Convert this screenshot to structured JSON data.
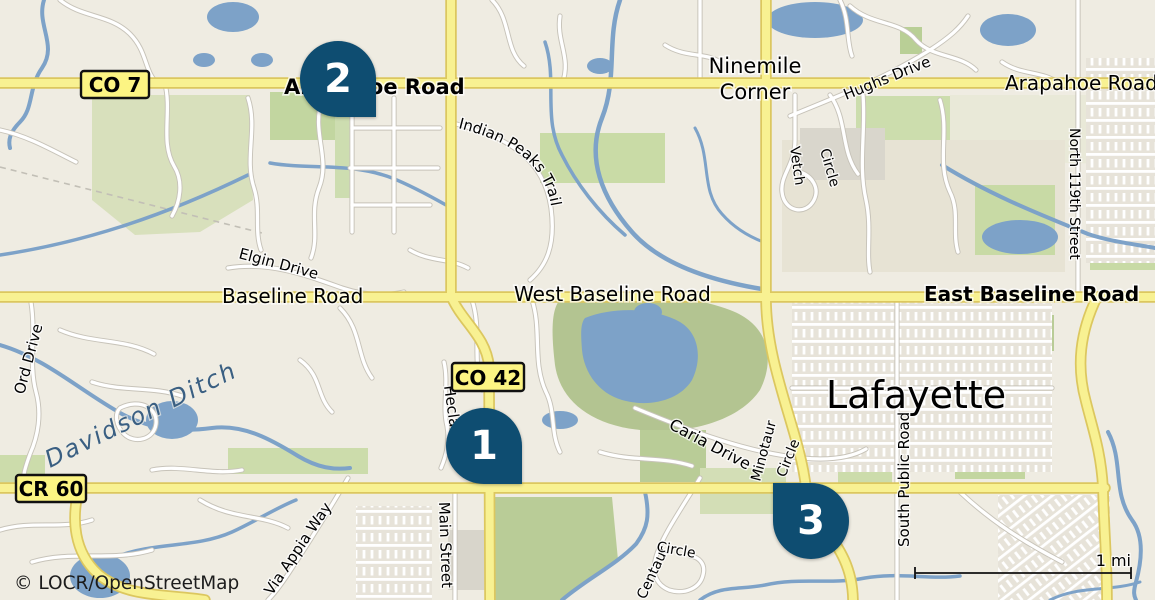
{
  "map": {
    "attribution": "© LOCR/OpenStreetMap",
    "scale": {
      "label": "1 mi"
    },
    "city": "Lafayette",
    "places": {
      "ninemile_line1": "Ninemile",
      "ninemile_line2": "Corner"
    },
    "badges": {
      "co7": "CO 7",
      "co42": "CO 42",
      "cr60": "CR 60"
    },
    "markers": [
      {
        "number": "1"
      },
      {
        "number": "2"
      },
      {
        "number": "3"
      }
    ],
    "roads": {
      "arapahoe_west": "Arapahoe Road",
      "arapahoe_east": "Arapahoe Road",
      "hughs_drive": "Hughs Drive",
      "north_119th_street": "North 119th Street",
      "indian_peaks_trail": "Indian Peaks Trail",
      "vetch_line1": "Vetch",
      "vetch_line2": "Circle",
      "elgin_drive": "Elgin Drive",
      "baseline_road": "Baseline Road",
      "west_baseline_road": "West Baseline Road",
      "east_baseline_road": "East Baseline Road",
      "ord_drive": "Ord Drive",
      "hecla": "Hecla",
      "caria_drive": "Caria Drive",
      "minotaur_line1": "Minotaur",
      "minotaur_line2": "Circle",
      "main_street": "Main Street",
      "via_appia_way": "Via Appia Way",
      "centaur_line1": "Centaur",
      "centaur_line2": "Circle",
      "south_public_road": "South Public Road"
    },
    "water": {
      "davidson_ditch": "Davidson Ditch"
    },
    "colors": {
      "marker": "#0e4d71",
      "road_major": "#f8f192",
      "road_major_casing": "#dcc75f",
      "water": "#7da2c8",
      "green": "#c5d7a2",
      "background": "#efece2",
      "water_label": "#3a5f82",
      "badge_fill": "#fcf483"
    }
  }
}
